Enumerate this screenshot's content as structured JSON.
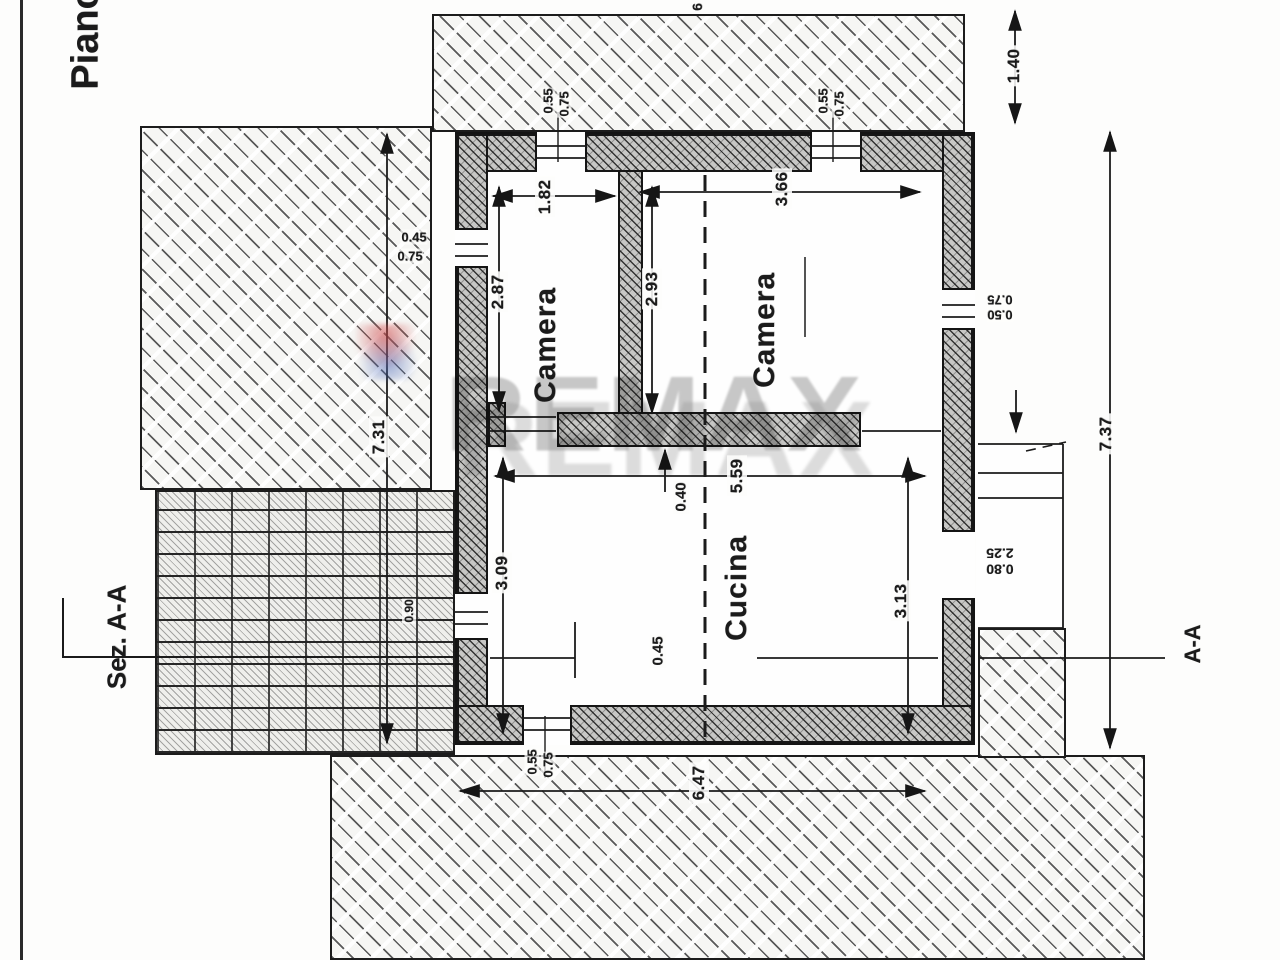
{
  "titles": {
    "plan_label": "Piano",
    "section_left": "Sez. A-A",
    "section_right": "A-A",
    "edge_dim": "6",
    "watermark": "REMAX"
  },
  "rooms": {
    "camera_left": "Camera",
    "camera_right": "Camera",
    "cucina": "Cucina"
  },
  "dims": {
    "camera_left_width": "1.82",
    "camera_left_depth": "2.87",
    "camera_right_width": "3.66",
    "camera_right_depth": "2.93",
    "cucina_width": "5.59",
    "cucina_depth_left": "3.09",
    "cucina_depth_right": "3.13",
    "wall_thickness": "0.40",
    "section_offset": "0.45",
    "overall_width_bottom": "6.47",
    "overall_height_left": "7.31",
    "overall_height_right": "7.37",
    "top_extension": "1.40"
  },
  "openings": {
    "window_top_left": [
      "0.55",
      "0.75"
    ],
    "window_top_right": [
      "0.55",
      "0.75"
    ],
    "window_left": [
      "0.45",
      "0.75"
    ],
    "window_right": [
      "0.50",
      "0.75"
    ],
    "door_right": [
      "0.80",
      "2.25"
    ],
    "window_bottom": [
      "0.55",
      "0.75"
    ],
    "door_left": [
      "0.90"
    ]
  }
}
